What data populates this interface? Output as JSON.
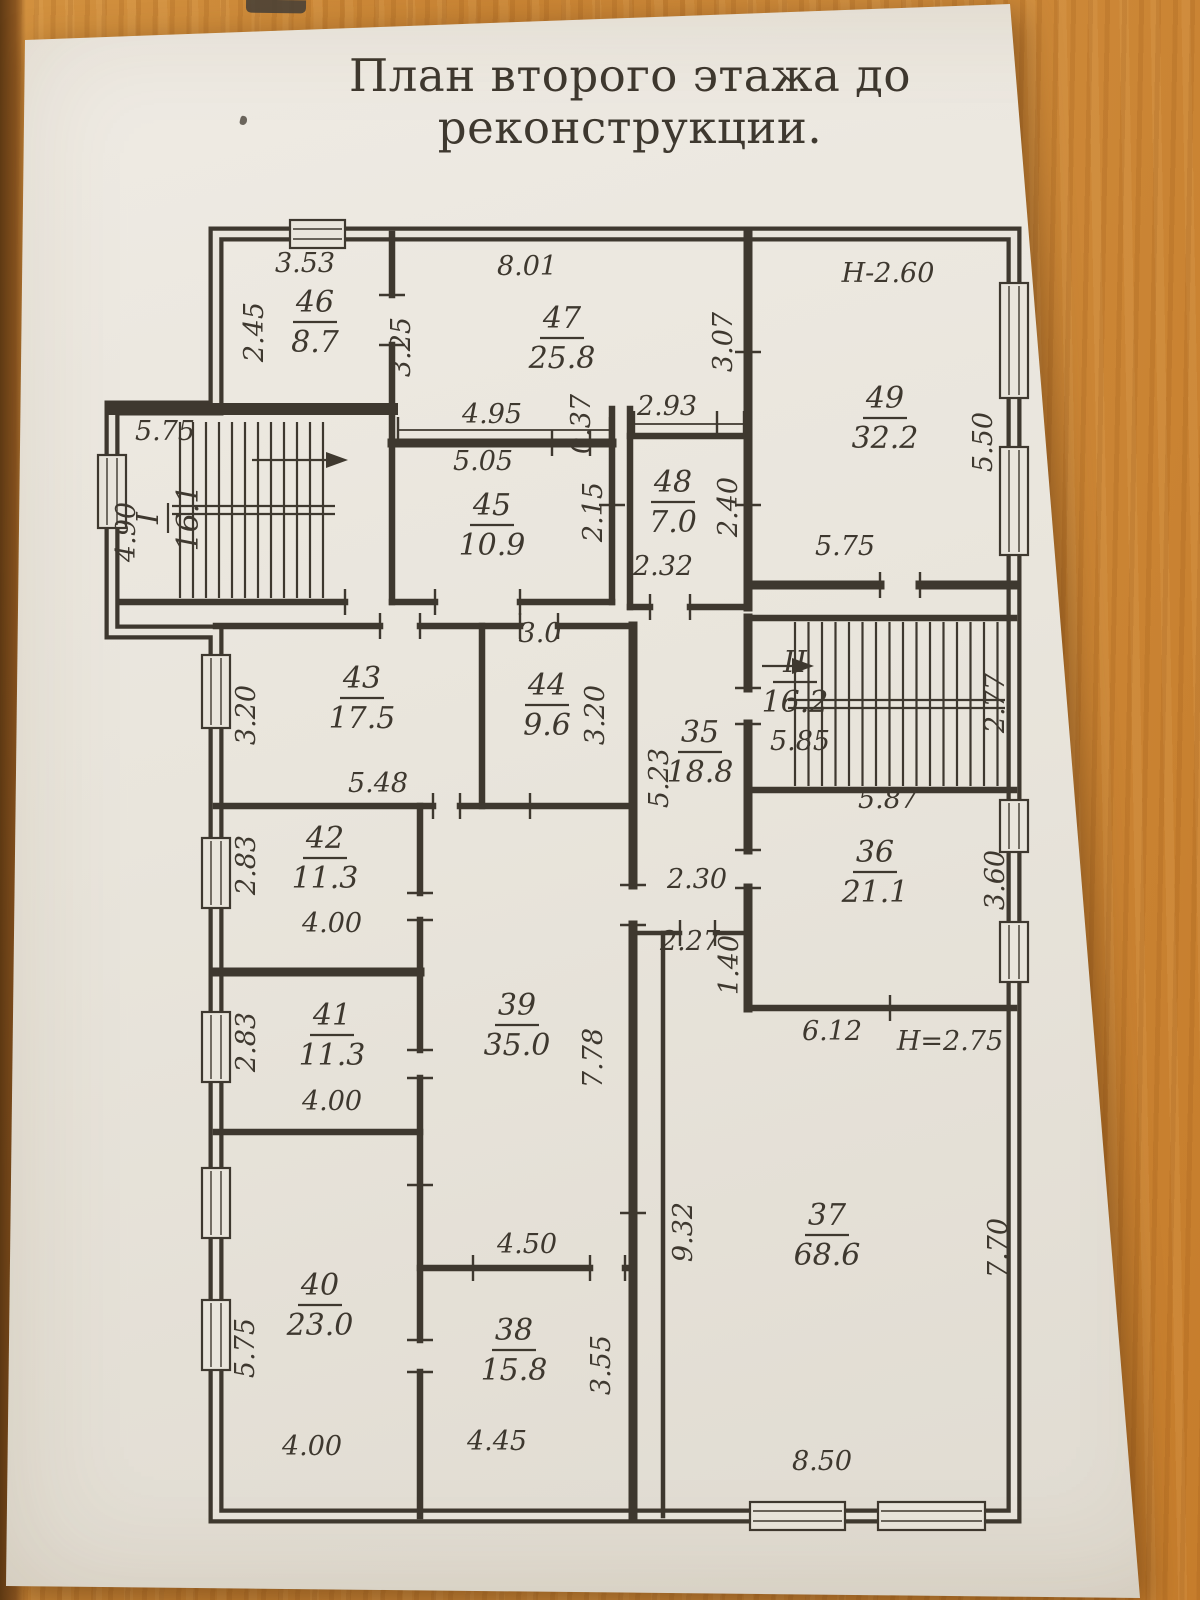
{
  "colors": {
    "ink": "#3e382f",
    "paper": "#e9e5dc",
    "wood": "#c98434"
  },
  "photo": {
    "title": "План второго этажа до реконструкции."
  },
  "floor_plan": {
    "rooms": [
      {
        "number": "46",
        "area": "8.7"
      },
      {
        "number": "47",
        "area": "25.8"
      },
      {
        "number": "49",
        "area": "32.2"
      },
      {
        "number": "45",
        "area": "10.9"
      },
      {
        "number": "48",
        "area": "7.0"
      },
      {
        "number": "I",
        "area": "16.1"
      },
      {
        "number": "43",
        "area": "17.5"
      },
      {
        "number": "44",
        "area": "9.6"
      },
      {
        "number": "35",
        "area": "18.8"
      },
      {
        "number": "II",
        "area": "16.2"
      },
      {
        "number": "36",
        "area": "21.1"
      },
      {
        "number": "42",
        "area": "11.3"
      },
      {
        "number": "41",
        "area": "11.3"
      },
      {
        "number": "39",
        "area": "35.0"
      },
      {
        "number": "40",
        "area": "23.0"
      },
      {
        "number": "38",
        "area": "15.8"
      },
      {
        "number": "37",
        "area": "68.6"
      }
    ],
    "dimensions": [
      "3.53",
      "8.01",
      "Н-2.60",
      "4.95",
      "2.93",
      "5.75",
      "5.05",
      "2.32",
      "5.75",
      "3.0",
      "5.48",
      "5.85",
      "5.87",
      "2.30",
      "2.27",
      "6.12",
      "Н=2.75",
      "4.00",
      "4.00",
      "4.50",
      "4.00",
      "4.45",
      "8.50",
      "2.45",
      "3.25",
      "0.37",
      "3.07",
      "5.50",
      "2.15",
      "2.40",
      "4.90",
      "3.20",
      "3.20",
      "5.23",
      "2.77",
      "3.60",
      "2.83",
      "2.83",
      "7.78",
      "1.40",
      "5.75",
      "3.55",
      "9.32",
      "7.70"
    ]
  }
}
